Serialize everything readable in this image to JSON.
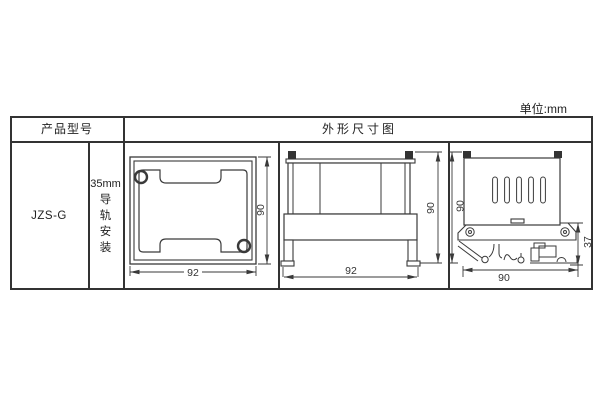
{
  "unit_note": "单位:mm",
  "colors": {
    "line": "#3a3a3a",
    "table_line": "#333333",
    "text": "#222222",
    "background": "#ffffff"
  },
  "table": {
    "header_product": "产品型号",
    "header_dimensions": "外形尺寸图",
    "product_model": "JZS-G",
    "mounting": {
      "size": "35mm",
      "chars": [
        "导",
        "轨",
        "安",
        "装"
      ]
    }
  },
  "views": {
    "front": {
      "width_mm": "92",
      "height_mm": "90"
    },
    "side": {
      "width_mm": "92",
      "height_mm": "90"
    },
    "rail": {
      "bottom_width_mm": "90",
      "height_mm": "90",
      "clip_height_mm": "37"
    }
  }
}
